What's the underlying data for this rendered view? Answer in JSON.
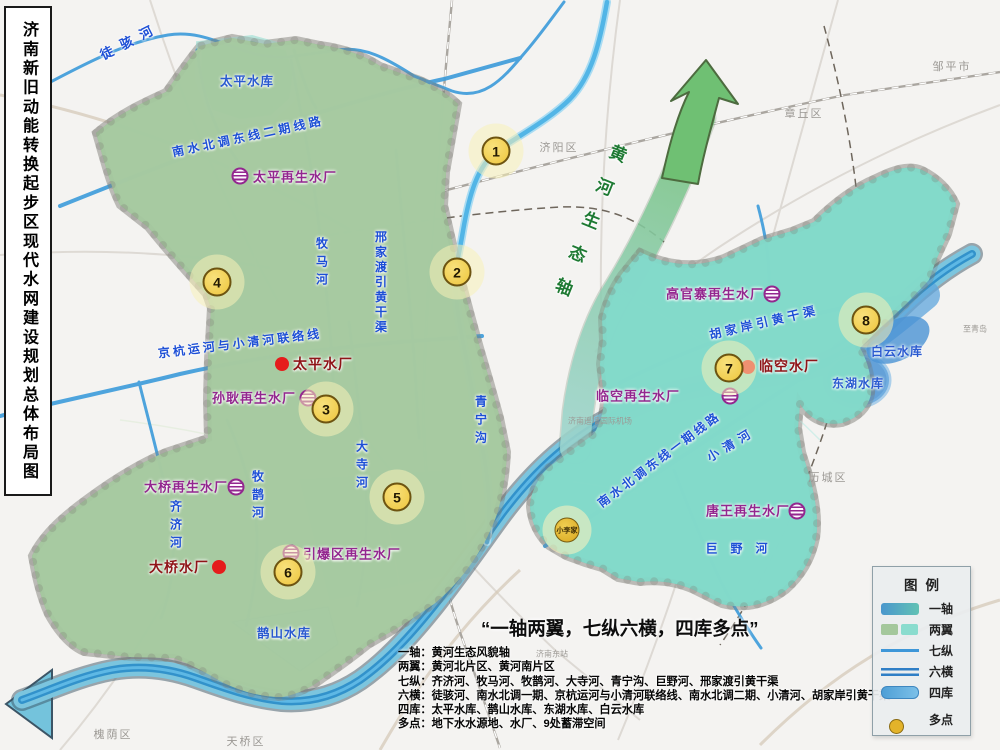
{
  "page": {
    "title": "济南新旧动能转换起步区现代水网建设规划总体布局图"
  },
  "slogan": "“一轴两翼，七纵六横，四库多点”",
  "notes": [
    "一轴：黄河生态风貌轴",
    "两翼：黄河北片区、黄河南片区",
    "七纵：齐济河、牧马河、牧鹊河、大寺河、青宁沟、巨野河、邢家渡引黄干渠",
    "六横：徒骇河、南水北调一期、京杭运河与小清河联络线、南水北调二期、小清河、胡家岸引黄干渠",
    "四库：太平水库、鹊山水库、东湖水库、白云水库",
    "多点：地下水水源地、水厂、9处蓄滞空间"
  ],
  "legend": {
    "title": "图例",
    "items": [
      "一轴",
      "两翼",
      "七纵",
      "六横",
      "四库",
      "多点"
    ]
  },
  "axis_label": "黄河生态轴",
  "rivers": {
    "tuohai": "徒骇河",
    "taiping_res": "太平水库",
    "nsbd2": "南水北调东线二期线路",
    "jinghang": "京杭运河与小清河联络线",
    "muma": "牧马河",
    "xingjiadu": "邢家渡引黄干渠",
    "qingning": "青宁沟",
    "dasi": "大寺河",
    "qiji": "齐济河",
    "muque": "牧鹊河",
    "queshan_res": "鹊山水库",
    "juye": "巨野河",
    "xiaoqing": "小清河",
    "hujiaan": "胡家岸引黄干渠",
    "nsbd1": "南水北调东线一期线路",
    "donghu_res": "东湖水库",
    "baiyun_res": "白云水库"
  },
  "plants": {
    "taiping_r": "太平再生水厂",
    "sungeng_r": "孙耿再生水厂",
    "daqiao_r": "大桥再生水厂",
    "yinbao_r": "引爆区再生水厂",
    "gaoguanzhai_r": "高官寨再生水厂",
    "linkong_r": "临空再生水厂",
    "tangwang_r": "唐王再生水厂",
    "taiping_w": "太平水厂",
    "daqiao_w": "大桥水厂",
    "linkong_w": "临空水厂"
  },
  "markers": {
    "n1": "1",
    "n2": "2",
    "n3": "3",
    "n4": "4",
    "n5": "5",
    "n6": "6",
    "n7": "7",
    "n8": "8",
    "xiaolijia": "小李家"
  },
  "districts": {
    "jiyang": "济阳区",
    "zouping": "邹平市",
    "zhangqiu": "章丘区",
    "licheng": "历城区",
    "huaiyin": "槐荫区",
    "tianqiao": "天桥区",
    "jinandong": "济南东站",
    "airport": "济南遥墙国际机场",
    "zhiqingdao": "至青岛"
  },
  "colors": {
    "wing_north": "#a6c9a0",
    "wing_south": "#83d9ca",
    "river_blue": "#3f9ddb",
    "axis_green": "#6fc073",
    "marker_yellow": "#f2cf4e",
    "plant_purple": "#93278f",
    "plant_red": "#e51c1c"
  }
}
